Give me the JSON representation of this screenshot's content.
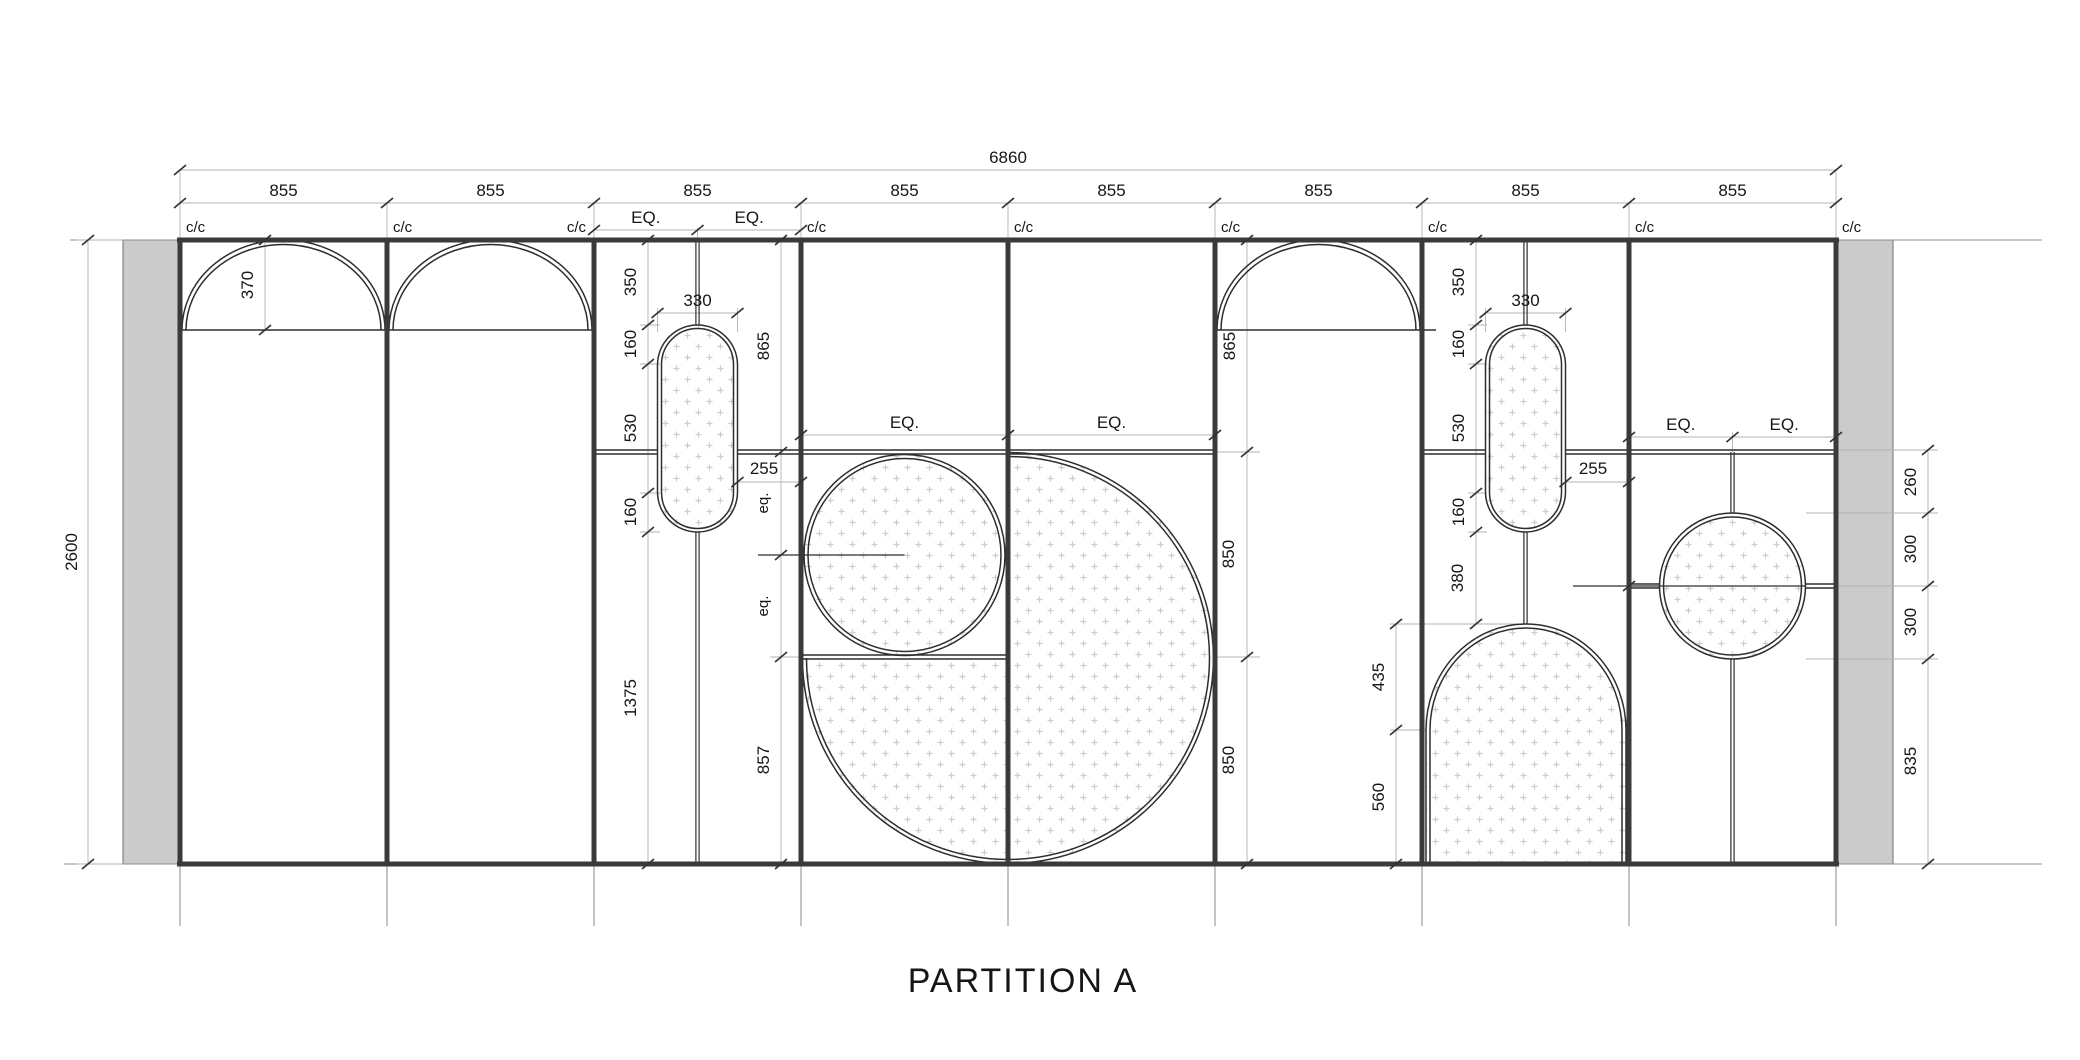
{
  "title": "PARTITION A",
  "labels": {
    "total_width": "6860",
    "bay": "855",
    "cc": "c/c",
    "eq": "EQ.",
    "eq_sm": "eq.",
    "height": "2600",
    "arch_rise": "370",
    "cap_offset": "350",
    "cap_width": "330",
    "cap_end": "160",
    "cap_mid": "530",
    "side_gap": "255",
    "head_height": "865",
    "below_capsule": "1375",
    "radius": "850",
    "quarter_height": "857",
    "dome_gap": "380",
    "dome_rise": "435",
    "dome_body": "560",
    "ring_gap": "260",
    "ring_radius": "300",
    "ring_below": "835"
  }
}
